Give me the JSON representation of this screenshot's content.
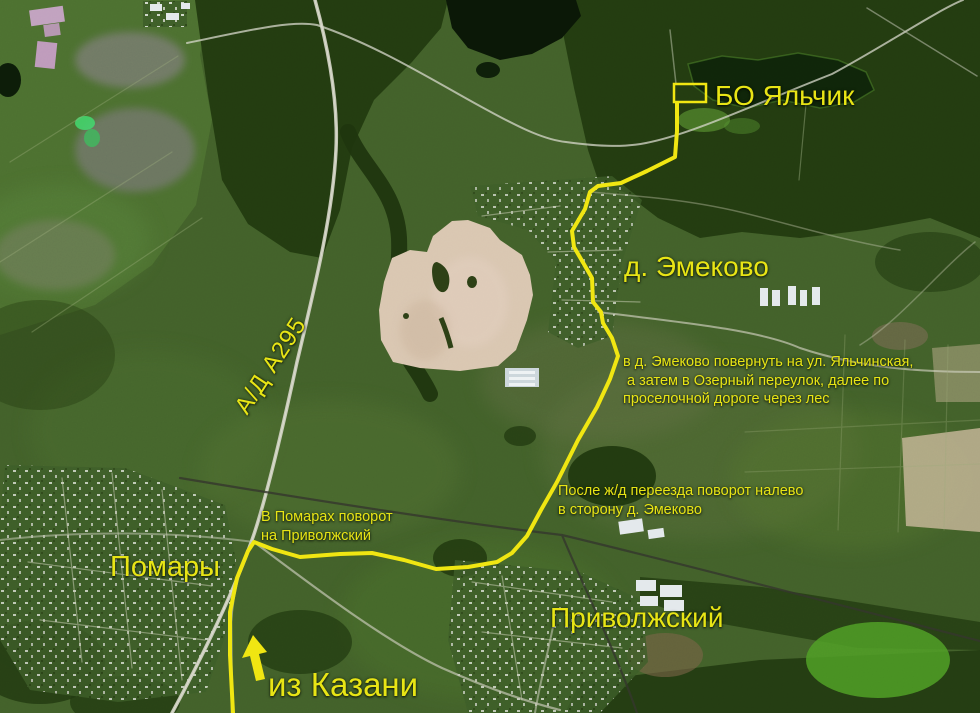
{
  "map": {
    "region_labels": {
      "bo_yalchik": "БО Яльчик",
      "emekovo": "д. Эмеково",
      "pomary": "Помары",
      "privolzhsky": "Приволжский",
      "highway_a295": "А/Д А295"
    },
    "route_labels": {
      "from_kazan": "из Казани"
    },
    "direction_notes": {
      "emekovo_turn_line1": "в д. Эмеково повернуть на ул. Яльчинская,",
      "emekovo_turn_line2": "а затем в Озерный переулок, далее по",
      "emekovo_turn_line3": "проселочной дороге через лес",
      "railway_turn_line1": "После ж/д переезда поворот налево",
      "railway_turn_line2": "в сторону д. Эмеково",
      "pomary_turn_line1": "В Помарах поворот",
      "pomary_turn_line2": "на Приволжский"
    },
    "colors": {
      "route_line": "#f0e612",
      "label_text": "#e8e515"
    }
  }
}
